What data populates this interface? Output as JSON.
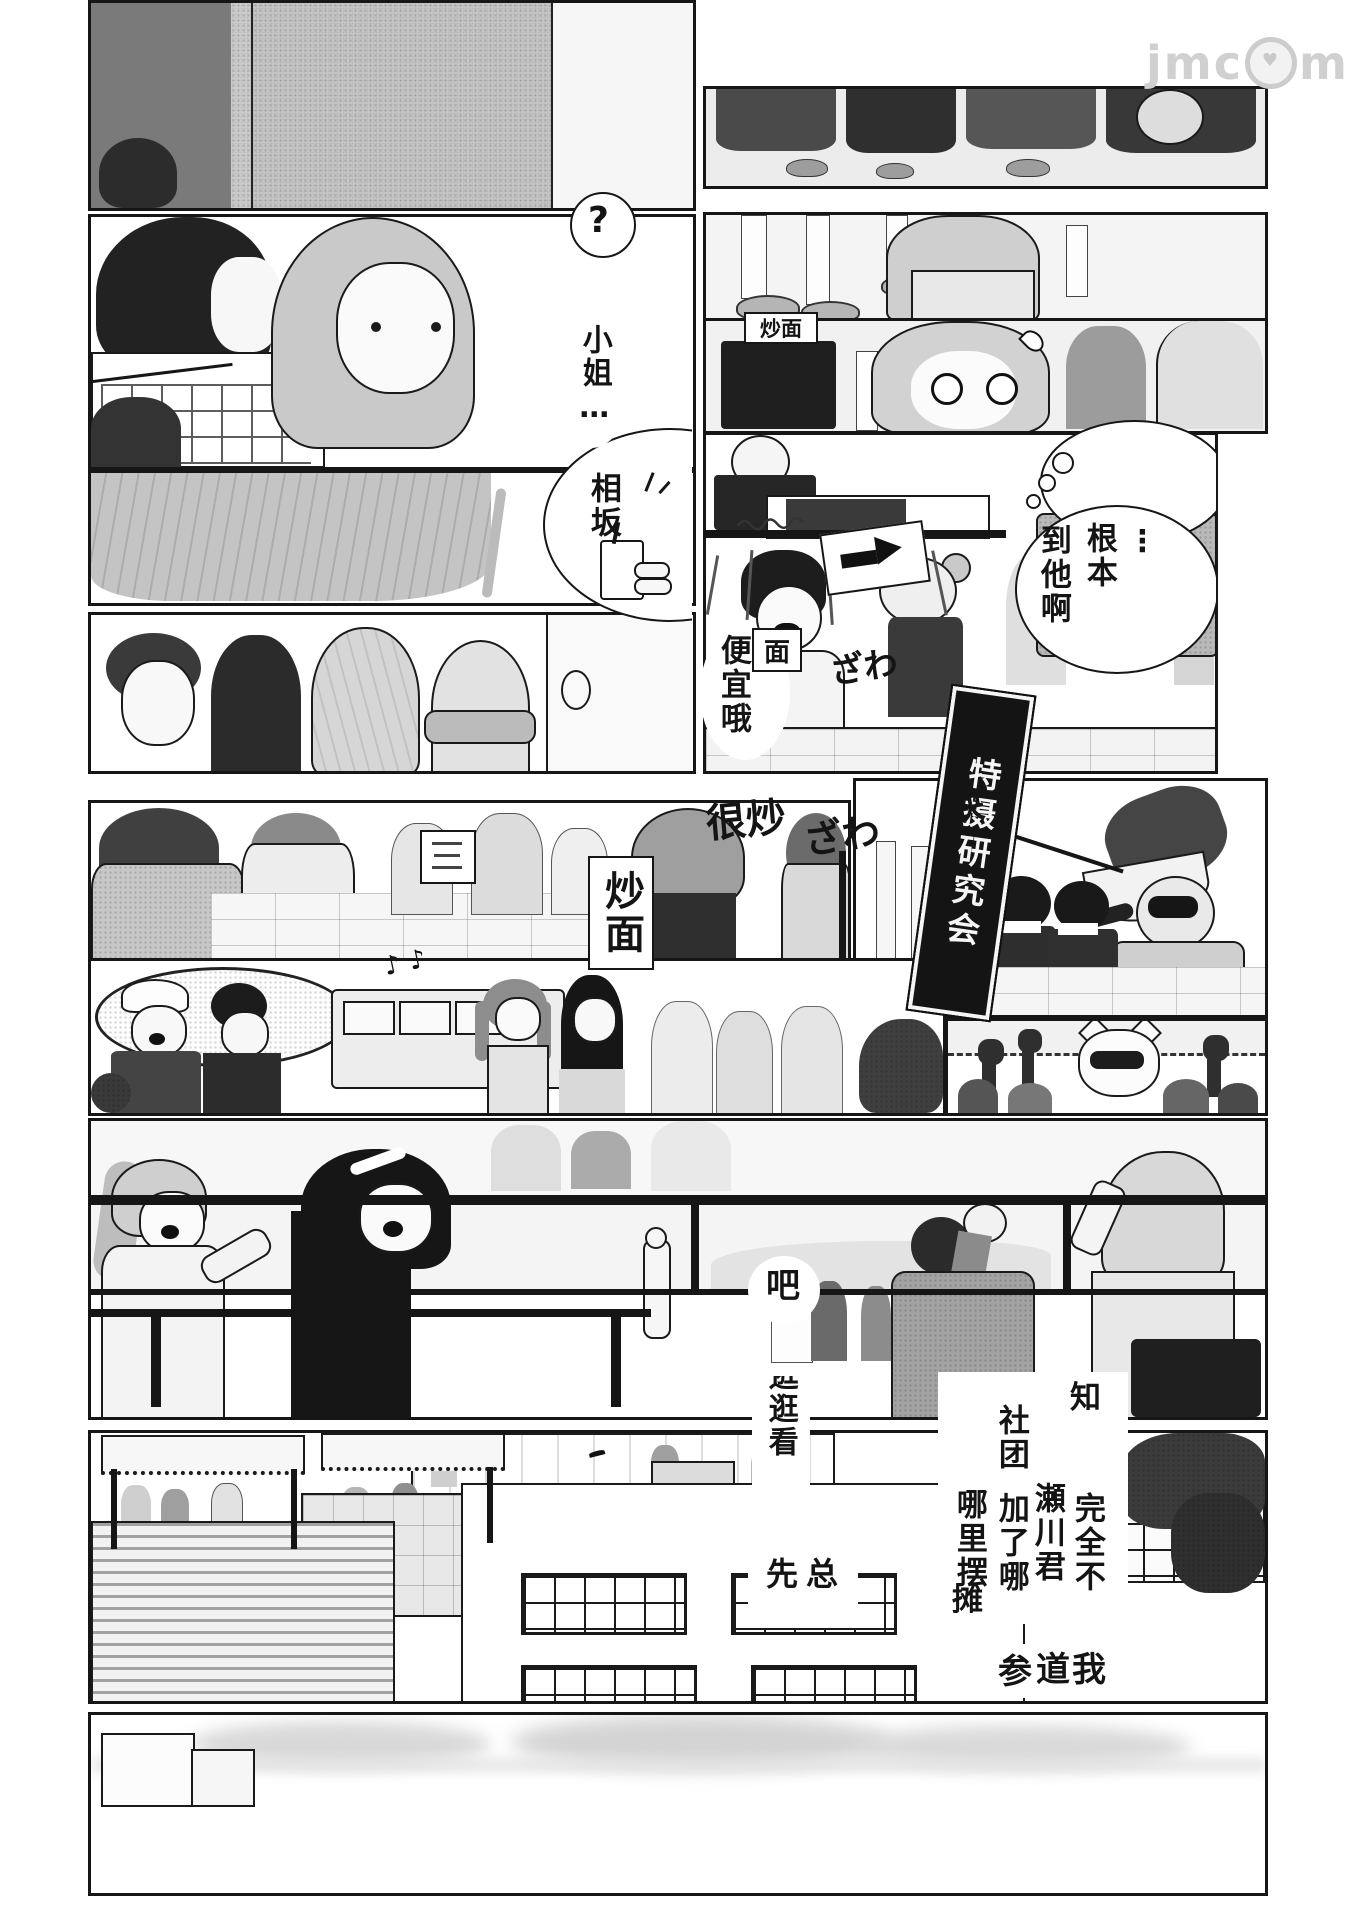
{
  "colors": {
    "ink": "#161616",
    "paper": "#ffffff",
    "watermark": "#cccccc"
  },
  "watermark": {
    "pre": "jmc",
    "post": "mic",
    "heart": "♥"
  },
  "bubbles": {
    "question": "?",
    "miss": "小姐…",
    "aisaka": "相坂",
    "ellipsis": "⋮",
    "genben": "根本",
    "daotaa": "到他啊",
    "cheap": "便宜哦",
    "ba": "吧",
    "zong": "总",
    "xian": "先",
    "guangguang": "逛逛看",
    "zhi": "知",
    "shetuan": "社团",
    "wanquanbu": "完全不",
    "segawa": "瀬川君",
    "jialena": "加了哪",
    "nalibai": "哪里摆",
    "tan": "摊",
    "can": "参",
    "dao": "道",
    "wo": "我"
  },
  "signs": {
    "yakisoba_h": "炒面",
    "mian": "面",
    "yakisoba_v": "炒面",
    "club_banner": "特摄研究会"
  },
  "sfx": {
    "zawa1": "ざわ",
    "zawa2": "ざわ",
    "henchao": "很炒",
    "kuai": "快",
    "notes": "♪ ♪"
  }
}
